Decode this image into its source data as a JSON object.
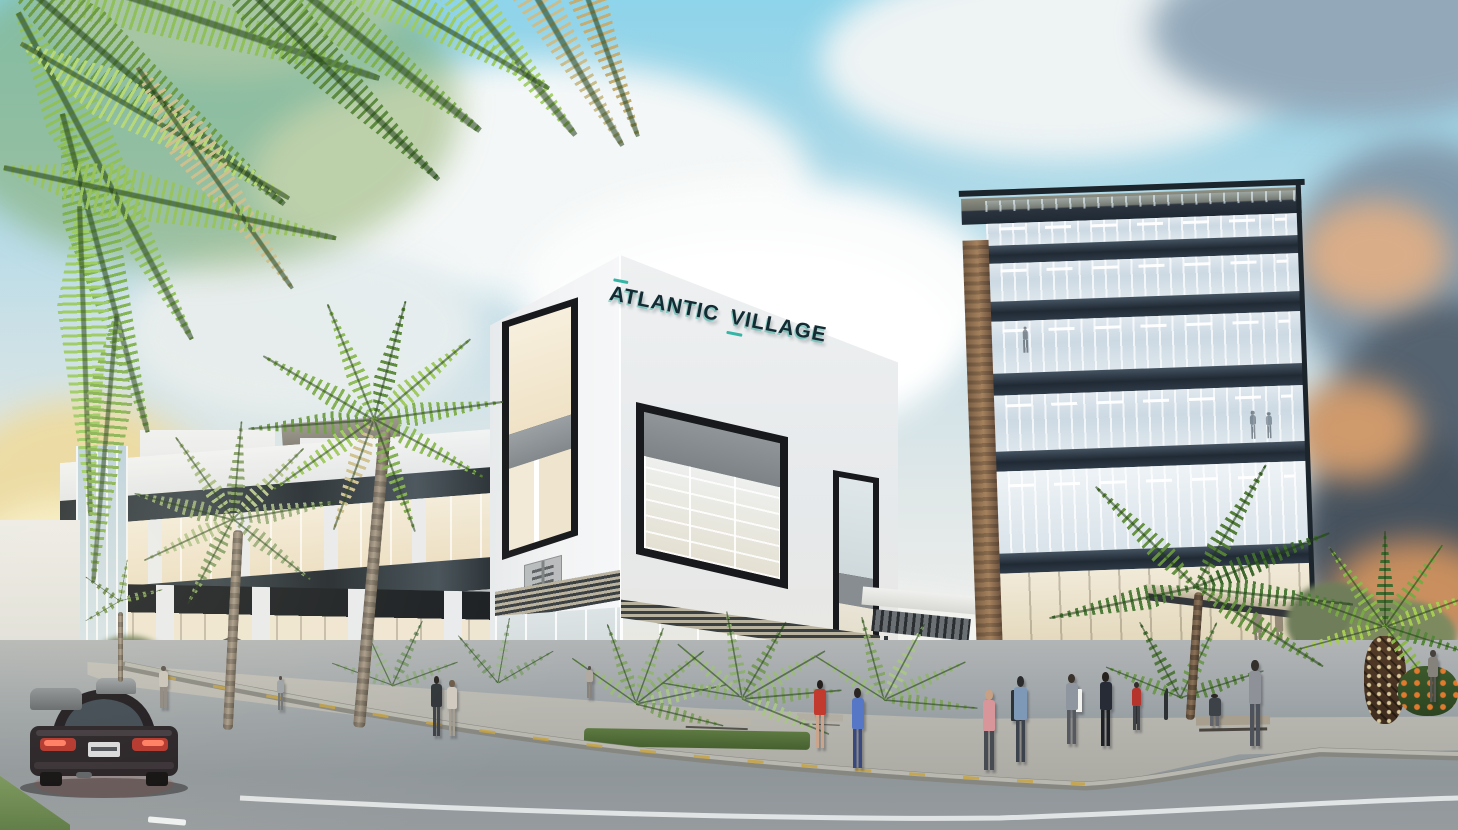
{
  "scene": {
    "type": "architectural-exterior-rendering",
    "description": "Street-level rendering of the Atlantic Village mixed-use complex: white retail buildings with teal signage, a glass office tower, palm trees, pedestrians on a gravel plaza, and a dark sedan on the foreground road under a partly cloudy tropical sky.",
    "sign": {
      "word1": "ATLANTIC",
      "word2": "VILLAGE"
    },
    "palette": {
      "sky_blue": "#8ed4ea",
      "cloud_white": "#f2f5f6",
      "cloud_grey": "#9fb6c6",
      "sunset_gold": "#ead9a0",
      "storm_grey": "#56606c",
      "storm_amber": "#c98f5e",
      "building_white": "#eff1f2",
      "frame_dark": "#1a1d20",
      "window_warm": "#f6eedd",
      "glass_blue": "#c7d6e2",
      "slab_dark": "#232e3a",
      "wood": "#967553",
      "palm_green": "#7fae4e",
      "palm_dry": "#c9bb8e",
      "road_grey": "#989fa3",
      "plaza_grey": "#b5b8b4",
      "curb_yellow": "#c8a23c",
      "car_black": "#1d191c",
      "taillight_red": "#d04038",
      "sign_teal": "#35b5a5",
      "sign_dark": "#152b33"
    }
  }
}
